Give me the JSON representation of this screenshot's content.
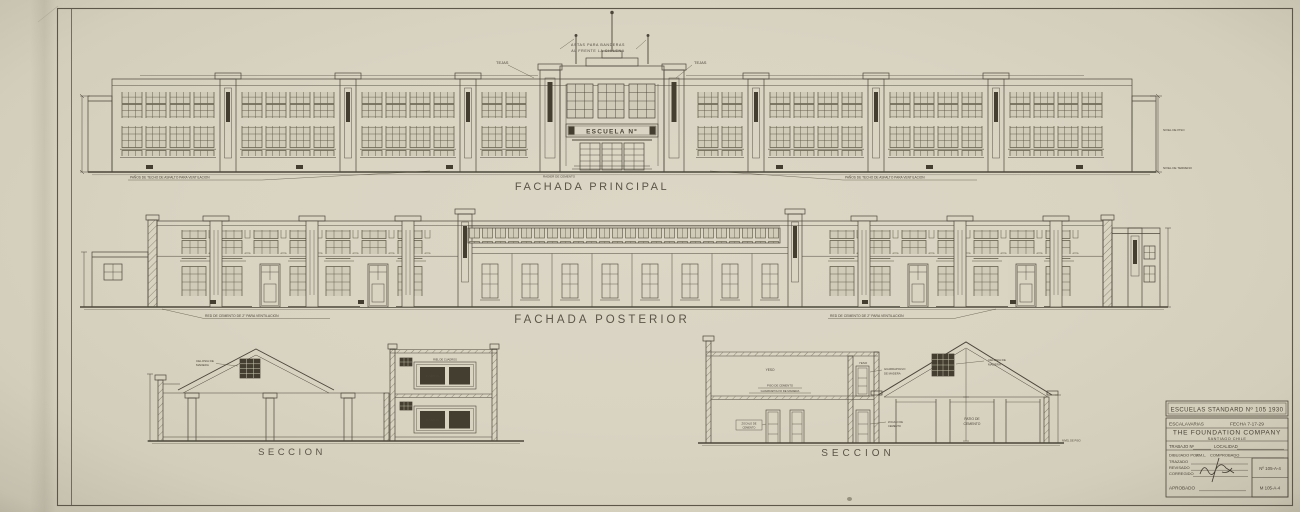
{
  "colors": {
    "paper": "#d9d3c2",
    "ink": "#4b4639",
    "dark_fill": "#433e2f"
  },
  "labels": {
    "principal": "FACHADA PRINCIPAL",
    "posterior": "FACHADA  POSTERIOR",
    "seccion_l": "SECCION",
    "seccion_r": "SECCION",
    "escuela": "ESCUELA Nº"
  },
  "ann": {
    "astas1": "ASTAS PARA BANDERAS",
    "astas2": "AL FRENTE LA CHILENA",
    "tejas_l": "TEJAS",
    "tejas_r": "TEJAS",
    "panos_l": "PAÑOS DE TECHO DE ASFALTO PARA VENTILACION",
    "panos_r": "PAÑOS DE TECHO DE ASFALTO PARA VENTILACION",
    "radier": "RADIER DE CEMENTO",
    "nivel_piso": "NIVEL DE PISO",
    "nivel_terreno": "NIVEL DE TERRENO",
    "red_l": "RED DE CEMENTO DE 2\" PARA VENTILACION",
    "red_r": "RED DE CEMENTO DE 2\" PARA VENTILACION",
    "celosia1a": "CELOSIA DE",
    "celosia1b": "MADERA",
    "celosia2a": "CELOSIA DE",
    "celosia2b": "MADERA",
    "riel": "RIEL DE CUADROS",
    "pizarron_u": "PIZARRON",
    "pizarron_d": "PIZARRON",
    "yeso1": "YESO",
    "yeso2": "YESO",
    "piso_cem": "PISO DE CEMENTO",
    "guardapolvo1": "GUARDAPOLVO DE MADERA",
    "guardapolvo2a": "GUARDAPOLVO",
    "guardapolvo2b": "DE MADERA",
    "zocalo1a": "ZOCALO DE",
    "zocalo1b": "CEMENTO",
    "zocalo2a": "ZOCALO DE",
    "zocalo2b": "CEMENTO",
    "patio1": "PATIO DE",
    "patio2": "CEMENTO",
    "nivel_piso2": "NIVEL DE PISO"
  },
  "titleblock": {
    "title": "ESCUELAS STANDARD Nº 105 1930",
    "escala": "ESCALA",
    "escala_val": "VARIAS",
    "fecha": "FECHA 7-17-29",
    "company": "THE FOUNDATION COMPANY",
    "city": "SANTIAGO CHILE",
    "trabajo": "TRABAJO Nº",
    "localidad": "LOCALIDAD",
    "dibujado": "DIBUJADO POR",
    "dibujado_val": "J.M.L.",
    "comprobado": "COMPROBADO",
    "trazado": "TRAZADO",
    "revisado": "REVISADO",
    "corregido": "CORREGIDO",
    "aprobado": "APROBADO",
    "no1": "Nº 105-A-4",
    "no2": "M 105-A-4"
  }
}
